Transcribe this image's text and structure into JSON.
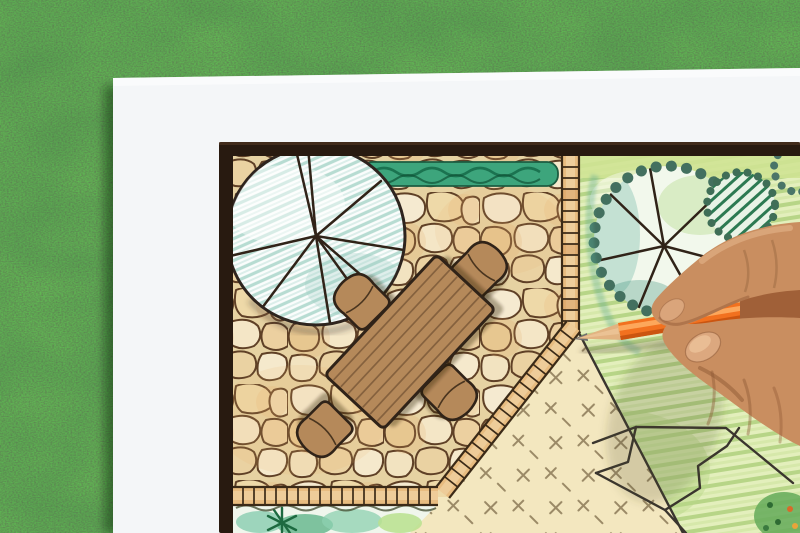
{
  "scene": {
    "description": "Overhead photo of a hand holding an orange colored pencil while drawing a garden landscape design plan on white paper lying on a grass lawn",
    "background": {
      "label": "artificial grass lawn"
    },
    "paper": {
      "label": "white drawing paper sheet"
    },
    "plan": {
      "label": "hand-drawn garden design plan with dark frame border",
      "patio": {
        "label": "flagstone paved patio",
        "stone_count_style": "irregular flagstones with dark ink outlines"
      },
      "table": {
        "label": "rectangular wooden plank table, drawn in plan view",
        "planks": 8
      },
      "chairs": {
        "label": "round-backed patio chairs",
        "count": 4
      },
      "round_tree": {
        "label": "large round tree canopy with radiating branch lines and teal hatching"
      },
      "scalloped_tree": {
        "label": "scallop-edged tree canopy with radiating branch lines over lawn"
      },
      "hatched_shrub": {
        "label": "small shrub with dark green diagonal hatching"
      },
      "hedge": {
        "label": "low clipped hedge strip along top edge"
      },
      "lawn": {
        "label": "green colored-pencil lawn with stroke texture"
      },
      "groundcover": {
        "label": "tan groundcover area marked with small cross dashes"
      },
      "planting_bed": {
        "label": "watercolor planting bed with small conifer"
      },
      "edging": {
        "label": "tile-strip path edging along patio border"
      },
      "bed_corner": {
        "label": "colorful planting bed in bottom-right corner"
      }
    },
    "pencil": {
      "label": "sharpened orange colored pencil"
    },
    "hand": {
      "label": "right hand gripping pencil between thumb and index finger"
    }
  },
  "palette": {
    "grass-base": "#4d7c40",
    "paper-white": "#f4f6f8",
    "frame-dark": "#281a10",
    "plan-cream": "#f6eed6",
    "stone-line": "#5f4026",
    "garden-green": "#dcecb2",
    "groundcover-tan": "#f3e7bf",
    "groundcover-mark": "#857351",
    "edging-tan": "#e8bc80",
    "edging-line": "#3b2a17",
    "furniture-wood": "#b5895a",
    "plank-line": "#7d5b3a",
    "ink-outline": "#302318",
    "hedge-green": "#3da57c",
    "tree-edge": "#43705f",
    "teal-hatch": "#b7dcd2",
    "shrub-green": "#2c7a52",
    "pencil-orange": "#f2711f",
    "pencil-wood": "#e2b381",
    "graphite-grey": "#6f6f6f",
    "skin-base": "#c98e60",
    "skin-shadow": "#a06038",
    "nail-pink": "#dca87f"
  }
}
